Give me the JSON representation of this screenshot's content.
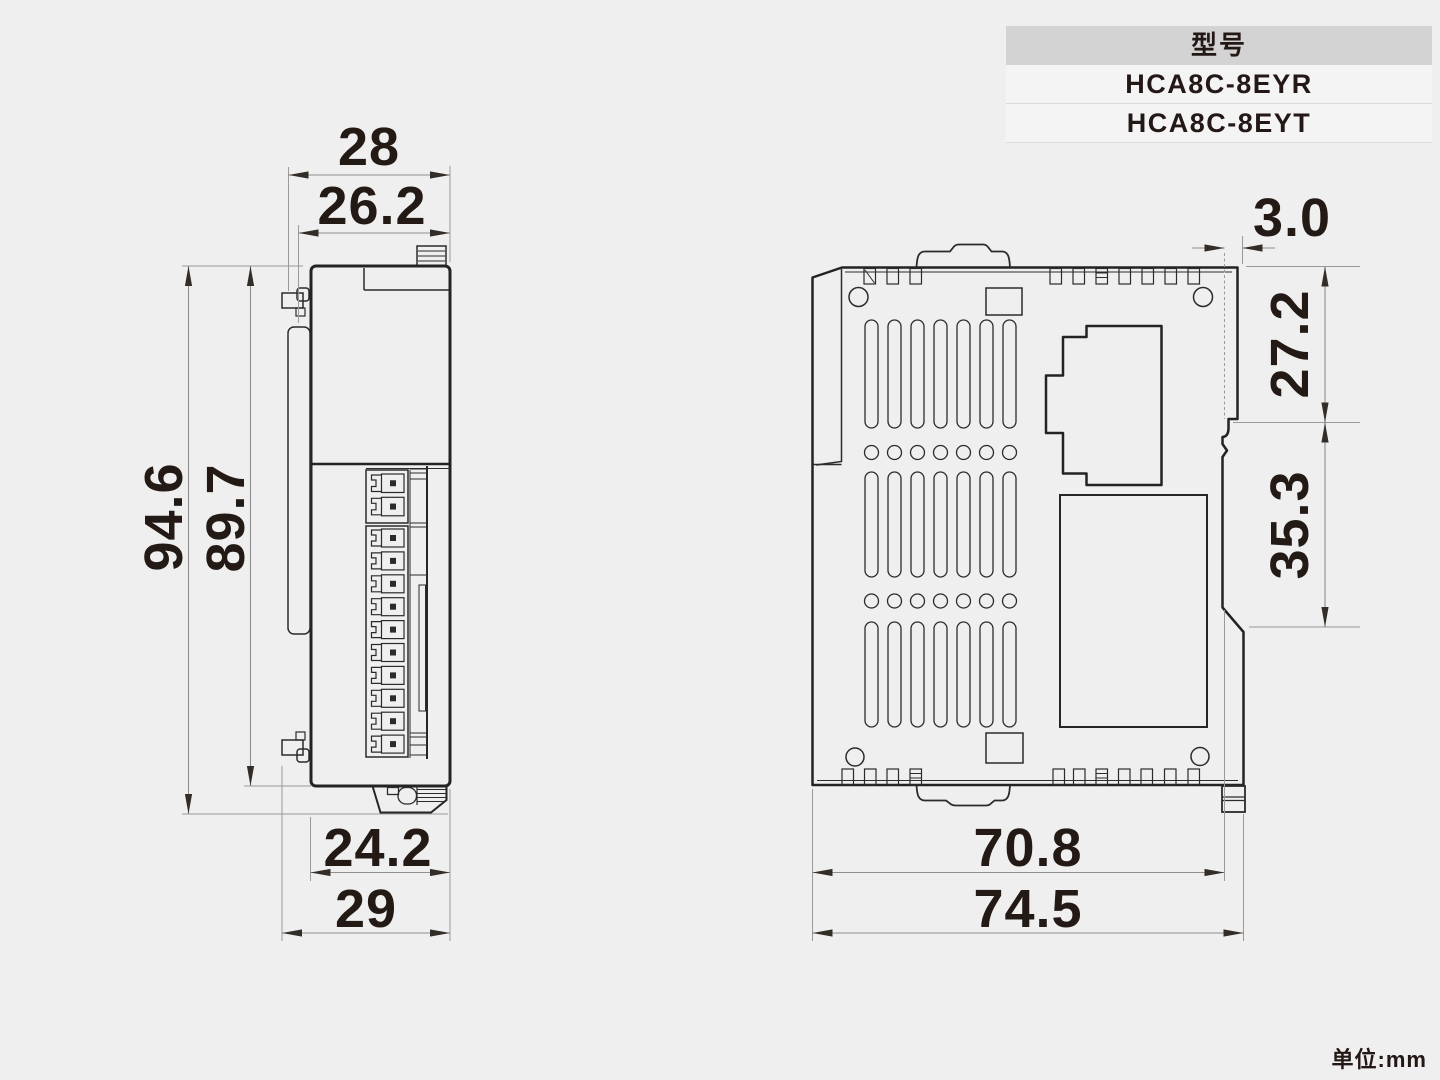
{
  "model_table": {
    "header": "型号",
    "rows": [
      "HCA8C-8EYR",
      "HCA8C-8EYT"
    ]
  },
  "unit_note": "单位:mm",
  "dims": {
    "front": {
      "top_outer": "28",
      "top_inner": "26.2",
      "height_outer": "94.6",
      "height_inner": "89.7",
      "bottom_inner": "24.2",
      "bottom_outer": "29"
    },
    "side": {
      "tab_depth": "3.0",
      "upper_section": "27.2",
      "lower_section": "35.3",
      "body_width": "70.8",
      "total_width": "74.5"
    }
  },
  "structure": {
    "terminal_cells": 12,
    "vent_columns": 7,
    "vent_slot_rows": 3,
    "vent_hole_rows": 2
  },
  "colors": {
    "background": "#efefef",
    "part_line": "#2b2b2b",
    "dimension_line": "#9a9a9a",
    "text": "#231815",
    "table_header_bg": "#d3d3d4",
    "table_row_bg": "#f4f4f5"
  }
}
